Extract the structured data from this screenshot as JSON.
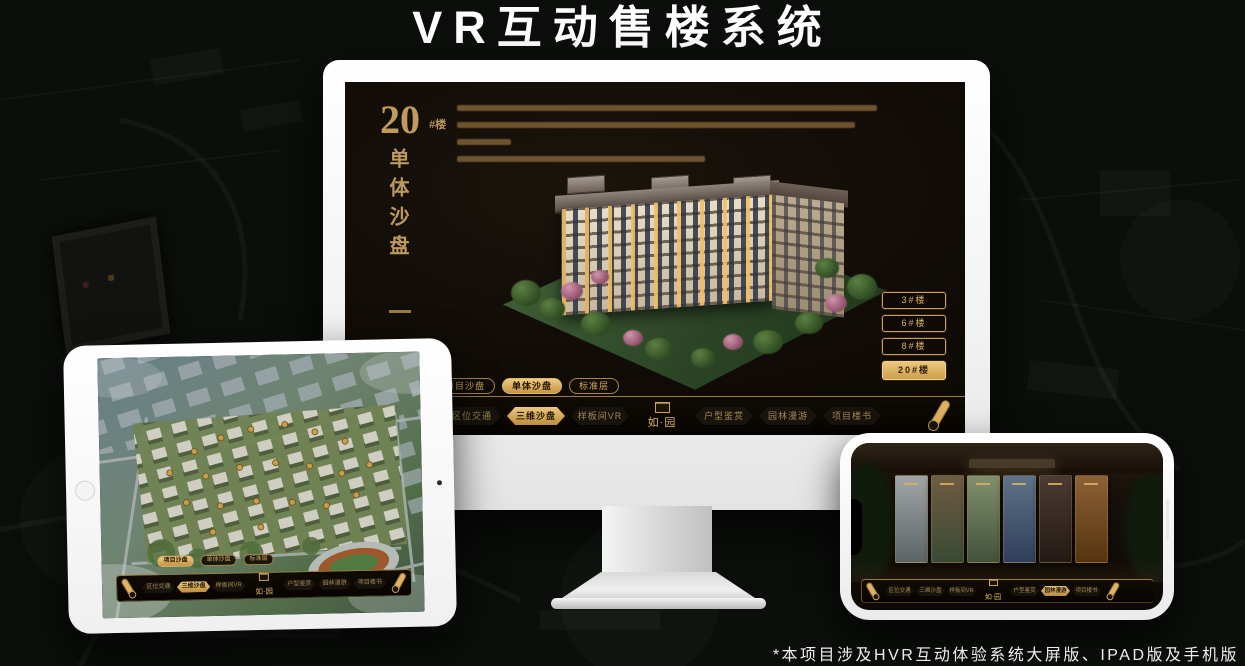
{
  "page": {
    "title": "VR互动售楼系统",
    "footnote": "*本项目涉及HVR互动体验系统大屏版、IPAD版及手机版"
  },
  "colors": {
    "gold": "#c89d5a",
    "gold_bright": "#eecb80",
    "screen_bg": "#120d07",
    "navbar_bg": "#0b0804",
    "active_text": "#241705"
  },
  "monitor": {
    "hero": {
      "number": "20",
      "suffix": "#楼",
      "title_vertical": "单体沙盘"
    },
    "floor_buttons": [
      {
        "label": "3#楼",
        "active": false
      },
      {
        "label": "6#楼",
        "active": false
      },
      {
        "label": "8#楼",
        "active": false
      },
      {
        "label": "20#楼",
        "active": true
      }
    ],
    "tabs": [
      {
        "label": "项目沙盘",
        "active": false
      },
      {
        "label": "单体沙盘",
        "active": true
      },
      {
        "label": "标准层",
        "active": false
      }
    ],
    "nav": {
      "logo": "如·园",
      "scroll_icon": "scroll-icon",
      "items": [
        {
          "label": "区位交通",
          "active": false
        },
        {
          "label": "三维沙盘",
          "active": true
        },
        {
          "label": "样板间VR",
          "active": false
        },
        {
          "label": "户型鉴赏",
          "active": false
        },
        {
          "label": "园林漫游",
          "active": false
        },
        {
          "label": "项目楼书",
          "active": false
        }
      ]
    }
  },
  "tablet": {
    "tabs": [
      {
        "label": "项目沙盘",
        "active": true
      },
      {
        "label": "单体沙盘",
        "active": false
      },
      {
        "label": "标准层",
        "active": false
      }
    ],
    "nav": {
      "logo": "如·园",
      "items": [
        {
          "label": "区位交通",
          "active": false
        },
        {
          "label": "三维沙盘",
          "active": true
        },
        {
          "label": "样板间VR",
          "active": false
        },
        {
          "label": "户型鉴赏",
          "active": false
        },
        {
          "label": "园林漫游",
          "active": false
        },
        {
          "label": "项目楼书",
          "active": false
        }
      ]
    }
  },
  "phone": {
    "nav": {
      "logo": "如·园",
      "items": [
        {
          "label": "区位交通",
          "active": false
        },
        {
          "label": "三维沙盘",
          "active": false
        },
        {
          "label": "样板间VR",
          "active": false
        },
        {
          "label": "户型鉴赏",
          "active": false
        },
        {
          "label": "园林漫游",
          "active": true
        },
        {
          "label": "项目楼书",
          "active": false
        }
      ]
    }
  }
}
